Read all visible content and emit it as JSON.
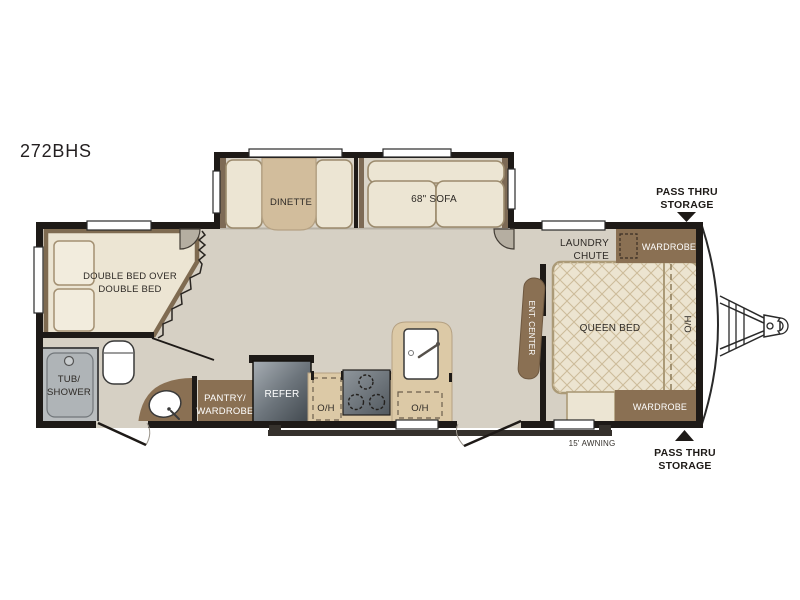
{
  "title": {
    "model": "272BHS"
  },
  "slideout": {
    "dinette": "DINETTE",
    "sofa": "68\" SOFA"
  },
  "bunk_room": {
    "label_line1": "DOUBLE BED OVER",
    "label_line2": "DOUBLE BED"
  },
  "bathroom": {
    "tub_line1": "TUB/",
    "tub_line2": "SHOWER"
  },
  "kitchen": {
    "pantry_line1": "PANTRY/",
    "pantry_line2": "WARDROBE",
    "refer": "REFER",
    "overhead_left": "O/H",
    "overhead_right": "O/H"
  },
  "bedroom": {
    "queen_bed": "QUEEN BED",
    "overhead_head": "O/H",
    "ent_center": "ENT. CENTER",
    "laundry_line1": "LAUNDRY",
    "laundry_line2": "CHUTE",
    "wardrobe_top": "WARDROBE",
    "wardrobe_bottom": "WARDROBE"
  },
  "exterior": {
    "pass_thru_top_line1": "PASS THRU",
    "pass_thru_top_line2": "STORAGE",
    "pass_thru_bottom_line1": "PASS THRU",
    "pass_thru_bottom_line2": "STORAGE",
    "awning": "15' AWNING"
  },
  "colors": {
    "wall": "#1e1a17",
    "floor": "#d6d0c4",
    "furniture_cream": "#ece5d3",
    "furniture_border": "#9b8a6c",
    "counter_tan": "#dcc9a6",
    "table_tan": "#d2bd9c",
    "cabinet_brown": "#8a7053",
    "appliance_gray": "#59616a",
    "tub_gray": "#b9bdbf",
    "lattice": "#cdbc9a",
    "label_text": "#2e2a26",
    "background": "#ffffff"
  }
}
